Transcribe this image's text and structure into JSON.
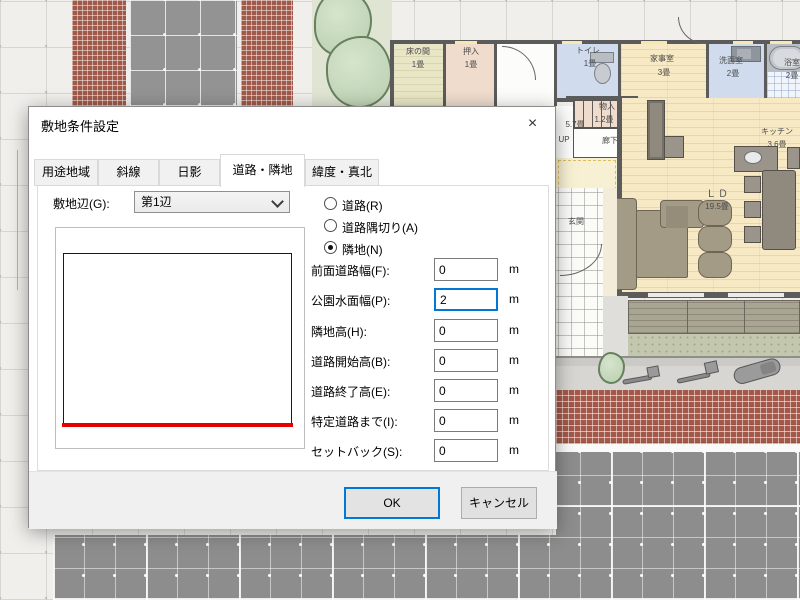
{
  "dialog": {
    "title": "敷地条件設定",
    "close_glyph": "×",
    "tabs": [
      {
        "label": "用途地域",
        "active": false
      },
      {
        "label": "斜線",
        "active": false
      },
      {
        "label": "日影",
        "active": false
      },
      {
        "label": "道路・隣地",
        "active": true
      },
      {
        "label": "緯度・真北",
        "active": false
      }
    ],
    "site_edge": {
      "label": "敷地辺(G):",
      "value": "第1辺"
    },
    "side_options": [
      {
        "label": "道路(R)",
        "selected": false
      },
      {
        "label": "道路隅切り(A)",
        "selected": false
      },
      {
        "label": "隣地(N)",
        "selected": true
      }
    ],
    "fields": [
      {
        "label": "前面道路幅(F):",
        "value": "0",
        "unit": "m",
        "focused": false
      },
      {
        "label": "公園水面幅(P):",
        "value": "2",
        "unit": "m",
        "focused": true
      },
      {
        "label": "隣地高(H):",
        "value": "0",
        "unit": "m",
        "focused": false
      },
      {
        "label": "道路開始高(B):",
        "value": "0",
        "unit": "m",
        "focused": false
      },
      {
        "label": "道路終了高(E):",
        "value": "0",
        "unit": "m",
        "focused": false
      },
      {
        "label": "特定道路まで(I):",
        "value": "0",
        "unit": "m",
        "focused": false
      },
      {
        "label": "セットバック(S):",
        "value": "0",
        "unit": "m",
        "focused": false
      }
    ],
    "buttons": {
      "ok": "OK",
      "cancel": "キャンセル"
    },
    "accent_color": "#0078d7",
    "preview_line_color": "#e60000"
  },
  "floorplan": {
    "rooms": {
      "tokonoma": {
        "name": "床の間",
        "size": "1畳"
      },
      "oshiire": {
        "name": "押入",
        "size": "1畳"
      },
      "toilet": {
        "name": "トイレ",
        "size": "1畳"
      },
      "utility": {
        "name": "家事室",
        "size": "3畳"
      },
      "washroom": {
        "name": "洗面室",
        "size": "2畳"
      },
      "bath": {
        "name": "浴室",
        "size": "2畳"
      },
      "storage": {
        "name": "物入",
        "size": "1.2畳"
      },
      "hall": {
        "size": "5.7畳"
      },
      "corridor": {
        "name": "廊下"
      },
      "kitchen": {
        "name": "キッチン",
        "size": "3.6畳"
      },
      "living_dining": {
        "name": "ＬＤ",
        "size": "19.5畳"
      },
      "entrance": {
        "name": "玄関"
      }
    },
    "stairs": {
      "direction_label": "UP"
    }
  }
}
